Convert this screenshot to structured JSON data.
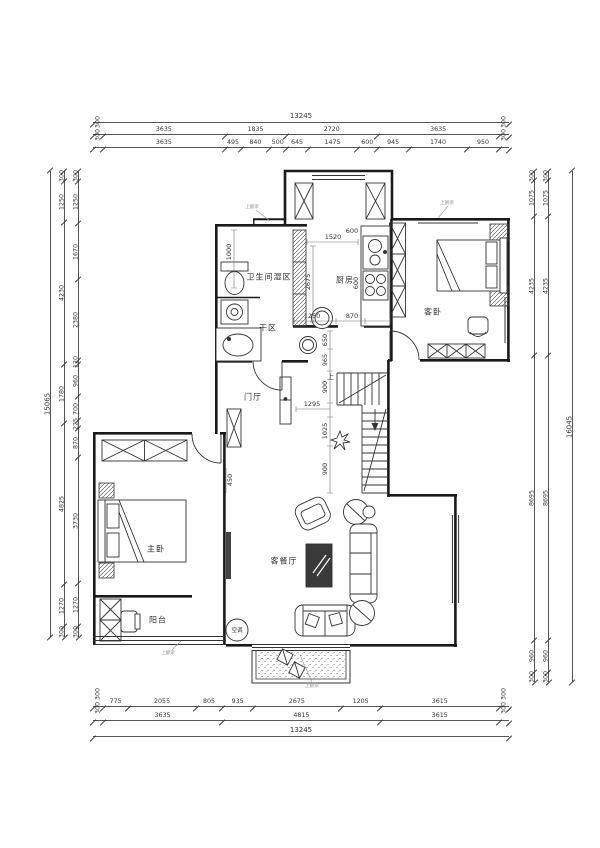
{
  "sheet": {
    "background": "#ffffff",
    "line_color": "#1a1a1a",
    "dim_color": "#555555"
  },
  "dims": {
    "top": {
      "total": "13245",
      "row1": [
        300,
        3635,
        1835,
        2720,
        3635,
        300
      ],
      "row2": [
        300,
        3635,
        495,
        840,
        500,
        645,
        1475,
        600,
        945,
        1740,
        950,
        300
      ]
    },
    "bottom": {
      "total": "13245",
      "row1": [
        300,
        775,
        2055,
        805,
        935,
        2675,
        1205,
        3615,
        300
      ],
      "row2": [
        300,
        3635,
        4815,
        3615,
        300
      ]
    },
    "left": {
      "total": "15065",
      "outer": [
        300,
        1250,
        4230,
        1780,
        4825,
        1270,
        300
      ],
      "inner": [
        300,
        1250,
        1670,
        2380,
        120,
        960,
        700,
        225,
        870,
        3730,
        1270,
        300
      ]
    },
    "right": {
      "total": "16045",
      "outer": [
        300,
        1075,
        4235,
        8695,
        960,
        300
      ],
      "inner": [
        300,
        1075,
        4235,
        8695,
        960,
        300
      ]
    }
  },
  "rooms": [
    {
      "id": "bathroom-wet",
      "label": "卫生间湿区"
    },
    {
      "id": "dry-area",
      "label": "干区"
    },
    {
      "id": "kitchen",
      "label": "厨房"
    },
    {
      "id": "guest-bedroom",
      "label": "客卧"
    },
    {
      "id": "foyer",
      "label": "门厅"
    },
    {
      "id": "master-bedroom",
      "label": "主卧"
    },
    {
      "id": "living-dining",
      "label": "客餐厅"
    },
    {
      "id": "balcony",
      "label": "阳台"
    }
  ],
  "fixtures": {
    "ac_label": "空调",
    "stair_up_label": "上"
  },
  "interior_dims": [
    {
      "text": "1000"
    },
    {
      "text": "1520"
    },
    {
      "text": "2675"
    },
    {
      "text": "600"
    },
    {
      "text": "600"
    },
    {
      "text": "1250"
    },
    {
      "text": "870"
    },
    {
      "text": "650"
    },
    {
      "text": "965"
    },
    {
      "text": "900"
    },
    {
      "text": "1295"
    },
    {
      "text": "1025"
    },
    {
      "text": "900"
    },
    {
      "text": "450"
    }
  ],
  "annotations": [
    {
      "text": "上翻梁"
    },
    {
      "text": "上翻梁"
    },
    {
      "text": "上翻梁"
    },
    {
      "text": "上翻梁"
    }
  ]
}
